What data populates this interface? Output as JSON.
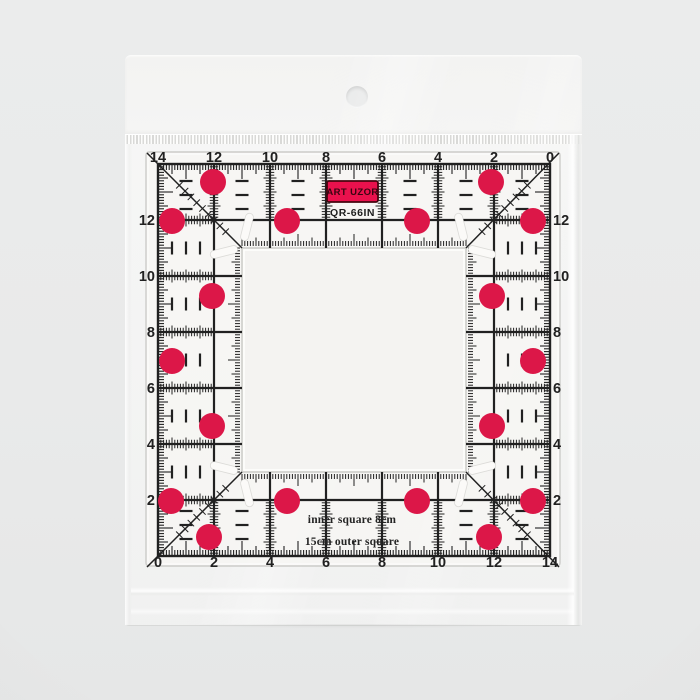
{
  "ruler": {
    "brand": "ART UZOR",
    "model": "QR-66IN",
    "caption_line1": "inner square 8cm",
    "caption_line2": "15cm outer square",
    "outer_size_cm": 15,
    "inner_size_cm": 8,
    "scales": {
      "top": [
        "14",
        "12",
        "10",
        "8",
        "6",
        "4",
        "2",
        "0"
      ],
      "bottom": [
        "0",
        "2",
        "4",
        "6",
        "8",
        "10",
        "12",
        "14"
      ],
      "left": [
        "12",
        "10",
        "8",
        "6",
        "4",
        "2"
      ],
      "right": [
        "12",
        "10",
        "8",
        "6",
        "4",
        "2"
      ]
    },
    "colors": {
      "ink": "#212121",
      "dot": "#dc1748",
      "label_bg": "#ea114d",
      "label_border": "#45060f",
      "label_text": "#370510"
    },
    "dots_px": [
      [
        213,
        182
      ],
      [
        491,
        182
      ],
      [
        172,
        221
      ],
      [
        287,
        221
      ],
      [
        417,
        221
      ],
      [
        533,
        221
      ],
      [
        212,
        296
      ],
      [
        492,
        296
      ],
      [
        172,
        361
      ],
      [
        533,
        361
      ],
      [
        212,
        426
      ],
      [
        492,
        426
      ],
      [
        171,
        501
      ],
      [
        287,
        501
      ],
      [
        417,
        501
      ],
      [
        533,
        501
      ],
      [
        209,
        537
      ],
      [
        489,
        537
      ]
    ]
  }
}
